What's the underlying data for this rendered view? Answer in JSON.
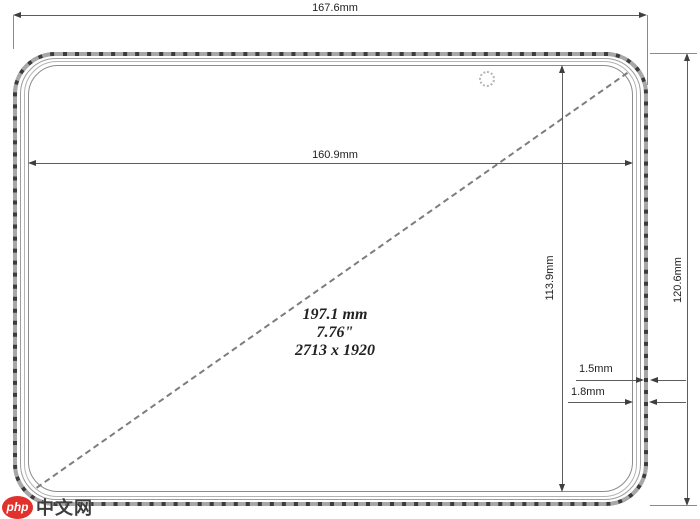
{
  "drawing": {
    "overall_width": {
      "label": "167.6mm"
    },
    "screen_width": {
      "label": "160.9mm"
    },
    "screen_height": {
      "label": "113.9mm"
    },
    "overall_height": {
      "label": "120.6mm"
    },
    "edge_front": {
      "label": "1.5mm"
    },
    "edge_side": {
      "label": "1.8mm"
    },
    "diagonal": {
      "mm": "197.1 mm",
      "inches": "7.76\"",
      "resolution": "2713 x 1920"
    },
    "line_color": "#5c5c5c",
    "body_color": "#3c3c3c"
  },
  "watermark": {
    "badge": "php",
    "site": "中文网",
    "badge_color": "#e0312d"
  }
}
